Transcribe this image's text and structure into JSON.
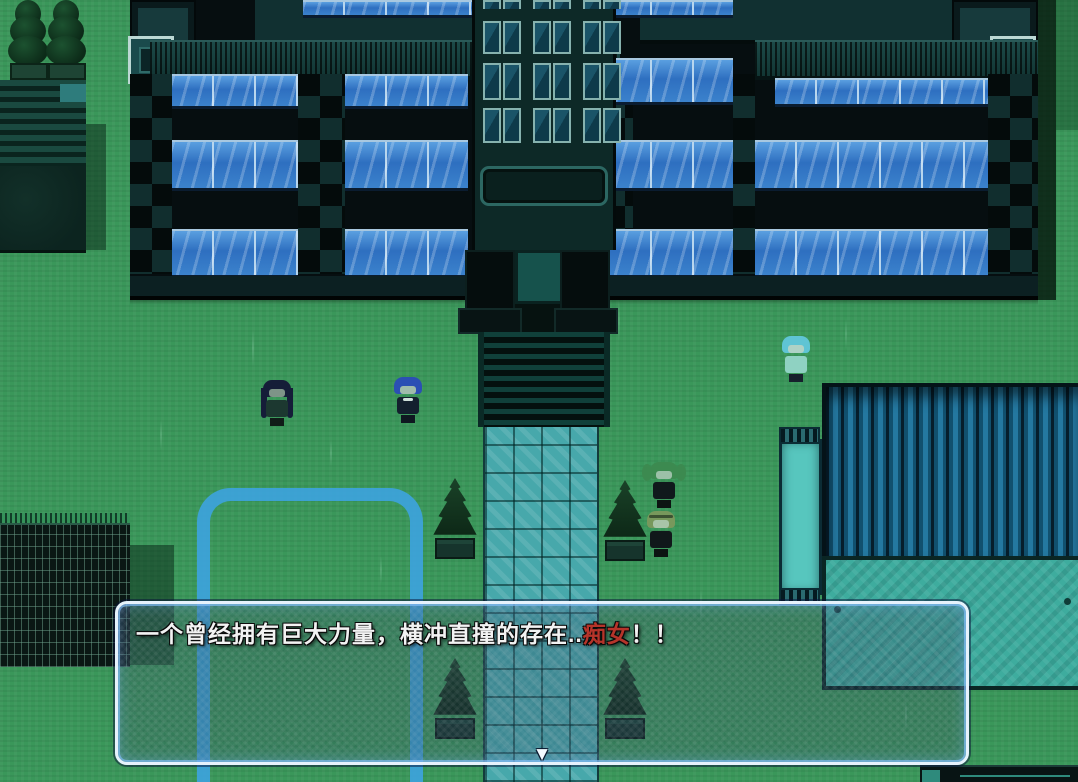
{
  "app": {
    "type": "rpg-game-screenshot",
    "scene": "dark-school-courtyard"
  },
  "dialogue_box": {
    "segments": [
      {
        "text": "一个曾经拥有巨大力量，横冲直撞的存在..",
        "color": "#f2f2f2"
      },
      {
        "text": "痴女",
        "color": "#b5342a"
      },
      {
        "text": "！！",
        "color": "#f2f2f2"
      }
    ],
    "continue_indicator": "▼"
  },
  "characters": [
    {
      "name": "long-dark-haired-girl"
    },
    {
      "name": "blue-haired-character"
    },
    {
      "name": "cyan-bob-girl"
    },
    {
      "name": "green-twintail-girl"
    },
    {
      "name": "olive-haired-girl"
    }
  ],
  "palette": {
    "grass_green": "#3a975a",
    "building_dark": "#060e10",
    "window_blue": "#3b82cc",
    "path_teal": "#47a8ab",
    "ground_marking_blue": "#3da3dc",
    "roof_corrugated_blue": "#2478a0",
    "mat_teal": "#3eac9e",
    "dialog_border": "#e6f2fc",
    "emphasis_red": "#b5342a",
    "text_white": "#f2f2f2"
  }
}
